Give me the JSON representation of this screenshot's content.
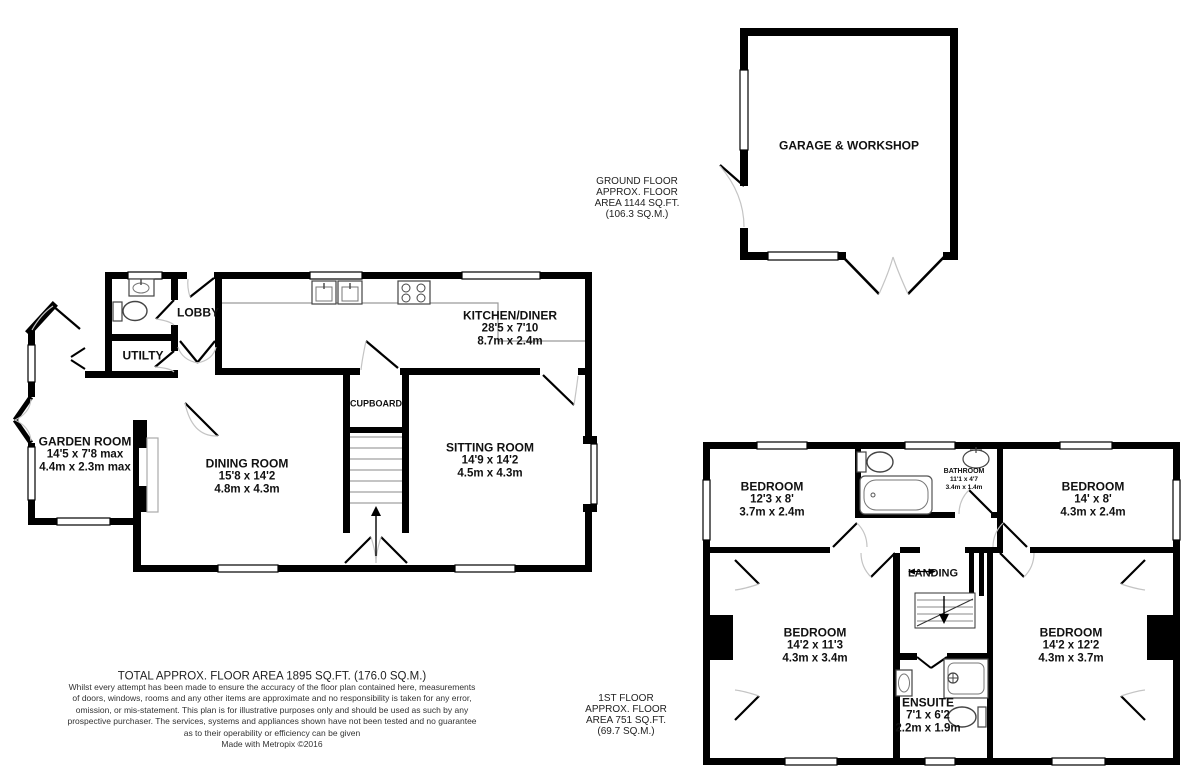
{
  "title": "Floor plan",
  "garage": {
    "name": "GARAGE & WORKSHOP"
  },
  "ground_label": {
    "lines": [
      "GROUND FLOOR",
      "APPROX. FLOOR",
      "AREA 1144 SQ.FT.",
      "(106.3 SQ.M.)"
    ]
  },
  "first_label": {
    "lines": [
      "1ST FLOOR",
      "APPROX. FLOOR",
      "AREA 751 SQ.FT.",
      "(69.7 SQ.M.)"
    ]
  },
  "rooms": {
    "kitchen": {
      "name": "KITCHEN/DINER",
      "ft": "28'5 x 7'10",
      "m": "8.7m x 2.4m"
    },
    "lobby": {
      "name": "LOBBY"
    },
    "utility": {
      "name": "UTILTY"
    },
    "cupboard": {
      "name": "CUPBOARD"
    },
    "garden": {
      "name": "GARDEN ROOM",
      "ft": "14'5 x 7'8 max",
      "m": "4.4m x 2.3m max"
    },
    "dining": {
      "name": "DINING ROOM",
      "ft": "15'8 x 14'2",
      "m": "4.8m x 4.3m"
    },
    "sitting": {
      "name": "SITTING ROOM",
      "ft": "14'9 x 14'2",
      "m": "4.5m x 4.3m"
    },
    "bed1": {
      "name": "BEDROOM",
      "ft": "12'3 x 8'",
      "m": "3.7m x 2.4m"
    },
    "bathroom": {
      "name": "BATHROOM",
      "ft": "11'1 x 4'7",
      "m": "3.4m x 1.4m"
    },
    "bed2": {
      "name": "BEDROOM",
      "ft": "14' x 8'",
      "m": "4.3m x 2.4m"
    },
    "bed3": {
      "name": "BEDROOM",
      "ft": "14'2 x 11'3",
      "m": "4.3m x 3.4m"
    },
    "landing": {
      "name": "LANDING"
    },
    "ensuite": {
      "name": "ENSUITE",
      "ft": "7'1 x 6'2",
      "m": "2.2m x 1.9m"
    },
    "bed4": {
      "name": "BEDROOM",
      "ft": "14'2 x 12'2",
      "m": "4.3m x 3.7m"
    }
  },
  "footer": {
    "total": "TOTAL APPROX. FLOOR AREA 1895 SQ.FT. (176.0 SQ.M.)",
    "disclaimer_lines": [
      "Whilst every attempt has been made to ensure the accuracy of the floor plan contained here, measurements",
      "of doors, windows, rooms and any other items are approximate and no responsibility is taken for any error,",
      "omission, or mis-statement. This plan is for illustrative purposes only and should be used as such by any",
      "prospective purchaser. The services, systems and appliances shown have not been tested and no guarantee",
      "as to their operability or efficiency can be given"
    ],
    "credit": "Made with Metropix ©2016"
  },
  "colors": {
    "wall": "#000000",
    "arc": "#c4c4c4",
    "fixture": "#444444",
    "counter": "#9a9a9a"
  }
}
